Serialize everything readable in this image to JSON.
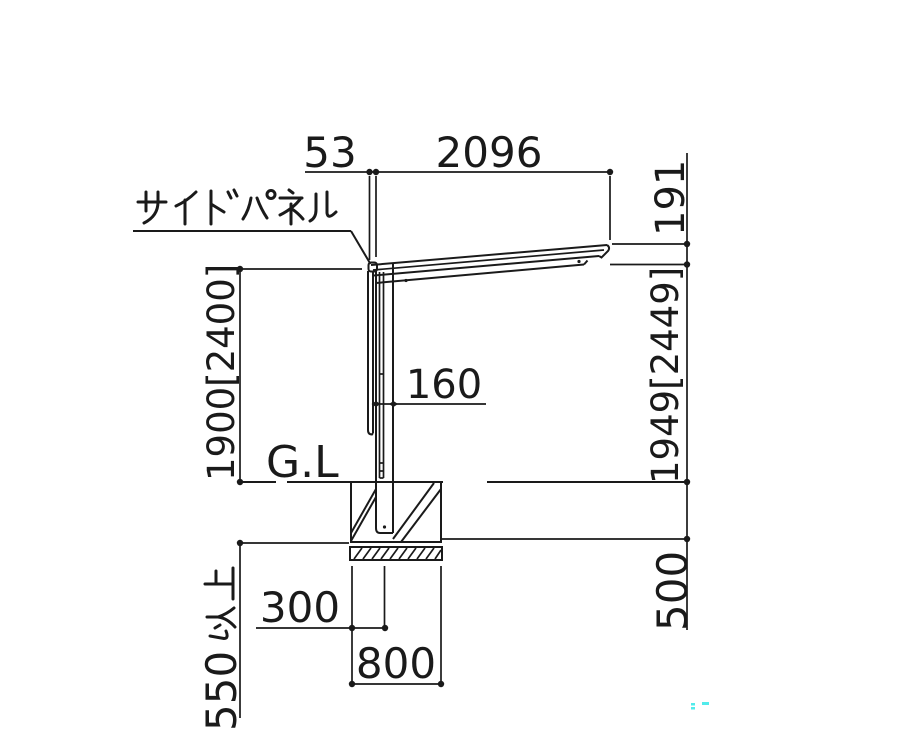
{
  "labels": {
    "side_panel": "サイドパネル",
    "ground_level": "G.L"
  },
  "dimensions": {
    "panel_to_post_offset": "53",
    "roof_projection": "2096",
    "roof_front_height": "191",
    "clearance_height": "1900[2400]",
    "post_section_depth": "160",
    "overall_height": "1949[2449]",
    "footing_depth": "500",
    "footing_edge_to_post": "300",
    "footing_width": "800",
    "min_embedment": {
      "number": "550",
      "suffix": "以上",
      "full": "550以上"
    }
  },
  "colors": {
    "line": "#1a1a1a",
    "background": "#ffffff",
    "watermark": "#35e8e8"
  }
}
